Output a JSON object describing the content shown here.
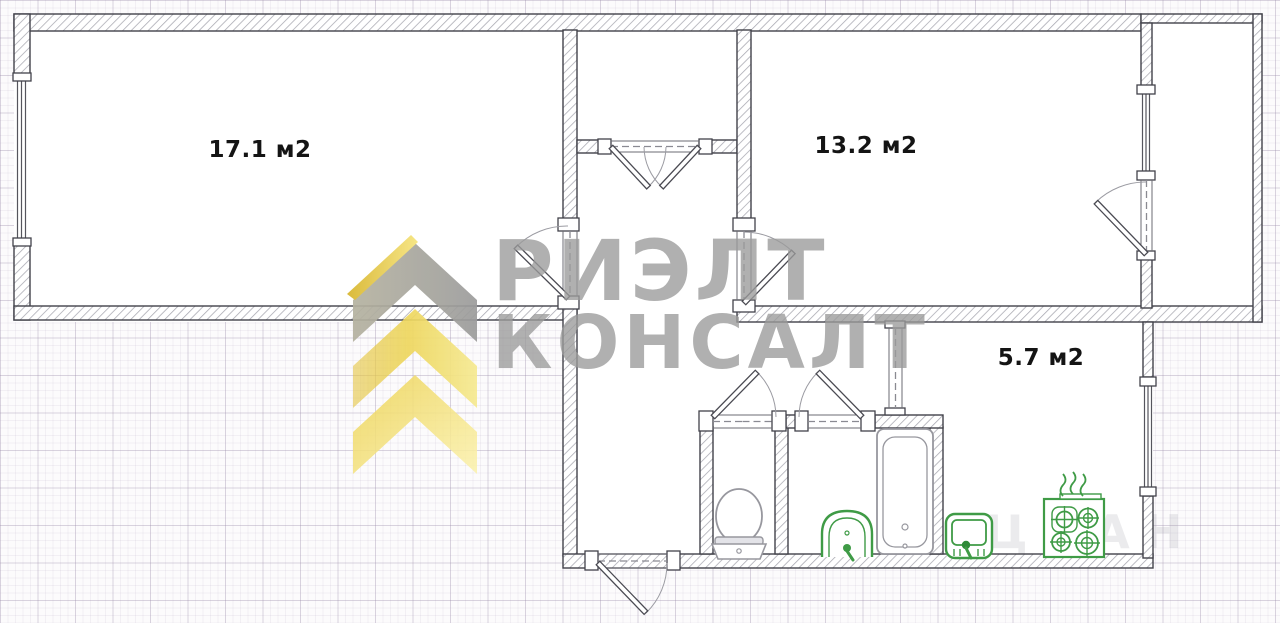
{
  "plan": {
    "type": "apartment-floor-plan",
    "rooms": {
      "living": {
        "name": "room-17",
        "area_label": "17.1 м2"
      },
      "bedroom": {
        "name": "room-13",
        "area_label": "13.2 м2"
      },
      "kitchen": {
        "name": "kitchen",
        "area_label": "5.7 м2"
      }
    },
    "fixtures": [
      "toilet-icon",
      "bathtub-icon",
      "bath-sink-icon",
      "kitchen-sink-icon",
      "stove-icon",
      "heat-waves-icon"
    ],
    "features": [
      "entrance-door",
      "closet-double-door",
      "balcony",
      "windows-3",
      "open-kitchen-passage"
    ]
  },
  "watermark": {
    "line1": "РИЭЛТ",
    "line2": "КОНСАЛТ",
    "ghost_text": "ЦИАН",
    "brand_gray": "#9b9b9b",
    "brand_yellow": "#e9cc45"
  },
  "colors": {
    "wall_outline": "#42424a",
    "wall_hatch": "#a7a7b0",
    "fixture_green": "#3f9b46",
    "fixture_gray": "#97979e",
    "label_black": "#141414",
    "grid": "#d9d0e0"
  }
}
